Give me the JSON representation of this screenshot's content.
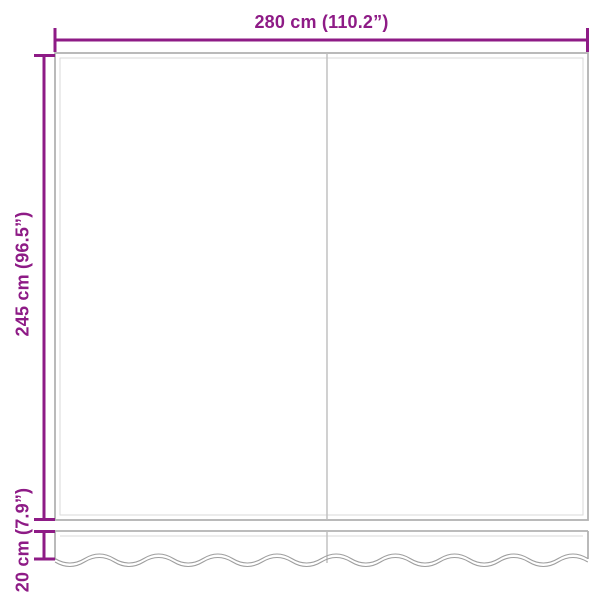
{
  "diagram": {
    "type": "product-dimension-diagram",
    "subject": "awning fabric with wavy valance, two panels",
    "labels": {
      "width": "280 cm (110.2”)",
      "height": "245 cm (96.5”)",
      "valance_height": "20 cm (7.9”)"
    },
    "colors": {
      "dimension": "#8E1B86",
      "outline": "#b2b2b2",
      "outline_inner": "#dadada",
      "seam": "#bdbdbd",
      "wave": "#9e9e9e",
      "background": "#ffffff"
    }
  }
}
